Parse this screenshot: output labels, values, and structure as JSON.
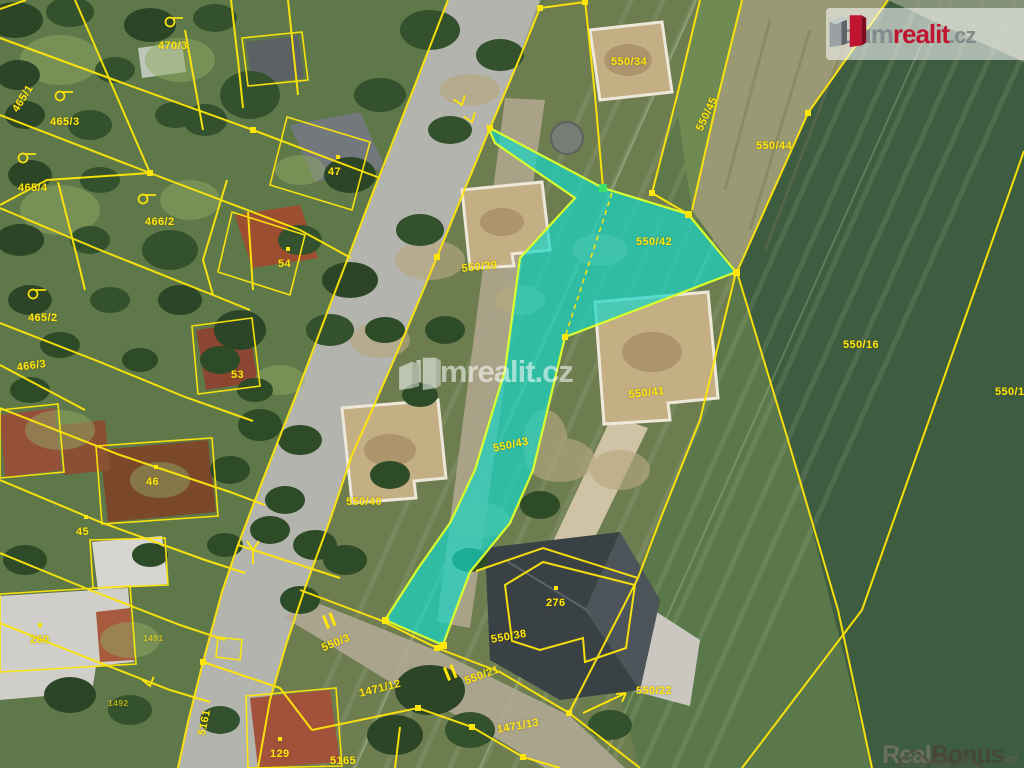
{
  "branding": {
    "logo": {
      "part1": "dum",
      "part2": "realit",
      "part3": ".cz"
    },
    "watermark_center": {
      "text": "dumrealit.cz"
    },
    "watermark_corner": {
      "part1": "Real",
      "part2": "Bonus",
      "part3": ".cz"
    }
  },
  "map": {
    "line_color": "#ffe60a",
    "highlight_color": "#17d6c6",
    "parcel_labels": [
      {
        "text": "470/3",
        "x": 158,
        "y": 40,
        "r": 0
      },
      {
        "text": "465/1",
        "x": 10,
        "y": 108,
        "r": -58
      },
      {
        "text": "465/3",
        "x": 50,
        "y": 116,
        "r": 0
      },
      {
        "text": "465/4",
        "x": 18,
        "y": 182,
        "r": 0
      },
      {
        "text": "466/2",
        "x": 145,
        "y": 216,
        "r": 0
      },
      {
        "text": "465/2",
        "x": 28,
        "y": 312,
        "r": 0
      },
      {
        "text": "466/3",
        "x": 16,
        "y": 362,
        "r": -8
      },
      {
        "text": "53",
        "x": 231,
        "y": 369,
        "r": 0
      },
      {
        "text": "47",
        "x": 328,
        "y": 166,
        "r": 0,
        "dot": true
      },
      {
        "text": "54",
        "x": 278,
        "y": 258,
        "r": 0,
        "dot": true
      },
      {
        "text": "46",
        "x": 146,
        "y": 476,
        "r": 0,
        "dot": true
      },
      {
        "text": "45",
        "x": 76,
        "y": 526,
        "r": 0,
        "dot": true
      },
      {
        "text": "260",
        "x": 30,
        "y": 634,
        "r": 0,
        "dot": true
      },
      {
        "text": "129",
        "x": 270,
        "y": 748,
        "r": 0,
        "dot": true
      },
      {
        "text": "5161",
        "x": 196,
        "y": 734,
        "r": -78
      },
      {
        "text": "5165",
        "x": 330,
        "y": 755,
        "r": 0
      },
      {
        "text": "1491",
        "x": 143,
        "y": 633,
        "r": 0,
        "s": 8.5,
        "o": 0.6
      },
      {
        "text": "1492",
        "x": 108,
        "y": 698,
        "r": 0,
        "s": 8.5,
        "o": 0.6
      },
      {
        "text": "550/34",
        "x": 611,
        "y": 56,
        "r": 0
      },
      {
        "text": "550/45",
        "x": 694,
        "y": 128,
        "r": -65
      },
      {
        "text": "550/44",
        "x": 756,
        "y": 140,
        "r": 0
      },
      {
        "text": "550/42",
        "x": 636,
        "y": 236,
        "r": 0
      },
      {
        "text": "550/39",
        "x": 461,
        "y": 263,
        "r": -6
      },
      {
        "text": "550/41",
        "x": 628,
        "y": 389,
        "r": -6
      },
      {
        "text": "550/40",
        "x": 346,
        "y": 496,
        "r": 0
      },
      {
        "text": "550/43",
        "x": 492,
        "y": 443,
        "r": -12
      },
      {
        "text": "550/16",
        "x": 843,
        "y": 339,
        "r": 0
      },
      {
        "text": "550/17",
        "x": 995,
        "y": 386,
        "r": 0
      },
      {
        "text": "276",
        "x": 546,
        "y": 597,
        "r": 0,
        "dot": true
      },
      {
        "text": "550/38",
        "x": 490,
        "y": 634,
        "r": -10
      },
      {
        "text": "550/3",
        "x": 320,
        "y": 643,
        "r": -22
      },
      {
        "text": "550/21",
        "x": 463,
        "y": 676,
        "r": -20
      },
      {
        "text": "550/22",
        "x": 636,
        "y": 685,
        "r": 0
      },
      {
        "text": "1471/12",
        "x": 358,
        "y": 688,
        "r": -14
      },
      {
        "text": "1471/13",
        "x": 496,
        "y": 724,
        "r": -10
      }
    ]
  }
}
